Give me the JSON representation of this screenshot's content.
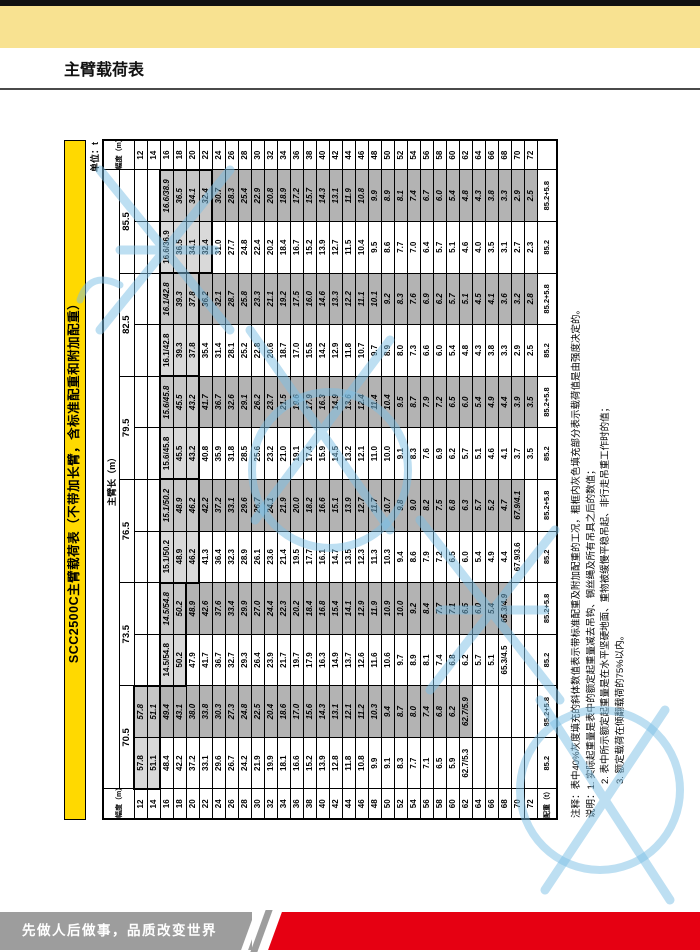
{
  "page": {
    "title": "主臂载荷表",
    "unit_label": "单位：t"
  },
  "table": {
    "title": "SCC2500C主臂载荷表（不带加长臂，含标准配重和附加配重）",
    "radius_header": "幅度（m）",
    "boom_header": "主臂长（m）",
    "counterweight_header": "配重（t）",
    "radii": [
      "12",
      "14",
      "16",
      "18",
      "20",
      "22",
      "24",
      "26",
      "28",
      "30",
      "32",
      "34",
      "36",
      "38",
      "40",
      "42",
      "44",
      "46",
      "48",
      "50",
      "52",
      "54",
      "56",
      "58",
      "60",
      "62",
      "64",
      "66",
      "68",
      "70",
      "72"
    ],
    "booms": [
      {
        "length": "70.5",
        "cw_std": "85.2",
        "cw_add": "85.2+5.8",
        "hl": [
          0,
          1
        ],
        "std": [
          "57.8",
          "51.1",
          "48.4",
          "42.2",
          "37.2",
          "33.1",
          "29.6",
          "26.7",
          "24.2",
          "21.9",
          "19.9",
          "18.1",
          "16.6",
          "15.2",
          "13.9",
          "12.8",
          "11.8",
          "10.8",
          "9.9",
          "9.1",
          "8.3",
          "7.7",
          "7.1",
          "6.5",
          "5.9",
          "62.7/5.3",
          "",
          "",
          "",
          "",
          ""
        ],
        "add": [
          "57.8",
          "51.1",
          "49.4",
          "43.1",
          "38.0",
          "33.8",
          "30.3",
          "27.3",
          "24.8",
          "22.5",
          "20.4",
          "18.6",
          "17.0",
          "15.6",
          "14.3",
          "13.1",
          "12.1",
          "11.2",
          "10.3",
          "9.4",
          "8.7",
          "8.0",
          "7.4",
          "6.8",
          "6.2",
          "62.7/5.9",
          "",
          "",
          "",
          "",
          ""
        ]
      },
      {
        "length": "73.5",
        "cw_std": "85.2",
        "cw_add": "85.2+5.8",
        "hl": [
          2,
          3
        ],
        "std": [
          "",
          "",
          "14.5/54.8",
          "50.2",
          "47.9",
          "41.7",
          "36.7",
          "32.7",
          "29.3",
          "26.4",
          "23.9",
          "21.7",
          "19.7",
          "17.9",
          "16.3",
          "14.9",
          "13.7",
          "12.6",
          "11.6",
          "10.6",
          "9.7",
          "8.9",
          "8.1",
          "7.4",
          "6.8",
          "6.2",
          "5.7",
          "5.1",
          "65.3/4.5",
          "",
          ""
        ],
        "add": [
          "",
          "",
          "14.5/54.8",
          "50.2",
          "48.9",
          "42.6",
          "37.6",
          "33.4",
          "29.9",
          "27.0",
          "24.4",
          "22.3",
          "20.2",
          "18.4",
          "16.8",
          "15.4",
          "14.1",
          "12.9",
          "11.9",
          "10.9",
          "10.0",
          "9.2",
          "8.4",
          "7.7",
          "7.1",
          "6.5",
          "6.0",
          "5.4",
          "65.3/4.9",
          "",
          ""
        ]
      },
      {
        "length": "76.5",
        "cw_std": "85.2",
        "cw_add": "85.2+5.8",
        "hl": [
          2,
          4
        ],
        "std": [
          "",
          "",
          "15.1/50.2",
          "48.9",
          "46.2",
          "41.3",
          "36.4",
          "32.3",
          "28.9",
          "26.1",
          "23.6",
          "21.4",
          "19.5",
          "17.7",
          "16.1",
          "14.7",
          "13.5",
          "12.3",
          "11.3",
          "10.3",
          "9.4",
          "8.6",
          "7.9",
          "7.2",
          "6.5",
          "6.0",
          "5.4",
          "4.9",
          "4.4",
          "67.9/3.6",
          ""
        ],
        "add": [
          "",
          "",
          "15.1/50.2",
          "48.9",
          "46.2",
          "42.2",
          "37.2",
          "33.1",
          "29.6",
          "26.7",
          "24.1",
          "21.9",
          "20.0",
          "18.2",
          "16.6",
          "15.1",
          "13.9",
          "12.7",
          "11.7",
          "10.7",
          "9.8",
          "9.0",
          "8.2",
          "7.5",
          "6.8",
          "6.3",
          "5.7",
          "5.2",
          "4.7",
          "67.9/4.1",
          ""
        ]
      },
      {
        "length": "79.5",
        "cw_std": "85.2",
        "cw_add": "85.2+5.8",
        "hl": [
          2,
          4
        ],
        "std": [
          "",
          "",
          "15.6/45.8",
          "45.5",
          "43.2",
          "40.8",
          "35.9",
          "31.8",
          "28.5",
          "25.6",
          "23.2",
          "21.0",
          "19.1",
          "17.4",
          "15.9",
          "14.5",
          "13.2",
          "12.1",
          "11.0",
          "10.0",
          "9.1",
          "8.3",
          "7.6",
          "6.9",
          "6.2",
          "5.7",
          "5.1",
          "4.6",
          "4.1",
          "3.7",
          "3.5"
        ],
        "add": [
          "",
          "",
          "15.6/45.8",
          "45.5",
          "43.2",
          "41.7",
          "36.7",
          "32.6",
          "29.1",
          "26.2",
          "23.7",
          "21.5",
          "19.6",
          "17.9",
          "16.3",
          "14.9",
          "13.6",
          "12.4",
          "11.4",
          "10.4",
          "9.5",
          "8.7",
          "7.9",
          "7.2",
          "6.5",
          "6.0",
          "5.4",
          "4.9",
          "4.4",
          "3.9",
          "3.5"
        ]
      },
      {
        "length": "82.5",
        "cw_std": "85.2",
        "cw_add": "85.2+5.8",
        "hl": [
          2,
          4
        ],
        "std": [
          "",
          "",
          "16.1/42.8",
          "39.3",
          "37.8",
          "35.4",
          "31.4",
          "28.1",
          "25.2",
          "22.8",
          "20.6",
          "18.7",
          "17.0",
          "15.5",
          "14.2",
          "12.9",
          "11.8",
          "10.7",
          "9.7",
          "8.9",
          "8.0",
          "7.3",
          "6.6",
          "6.0",
          "5.4",
          "4.8",
          "4.3",
          "3.8",
          "3.3",
          "2.9",
          "2.5"
        ],
        "add": [
          "",
          "",
          "16.1/42.8",
          "39.3",
          "37.8",
          "36.2",
          "32.1",
          "28.7",
          "25.8",
          "23.3",
          "21.1",
          "19.2",
          "17.5",
          "16.0",
          "14.6",
          "13.3",
          "12.2",
          "11.1",
          "10.1",
          "9.2",
          "8.3",
          "7.6",
          "6.9",
          "6.2",
          "5.7",
          "5.1",
          "4.5",
          "4.1",
          "3.6",
          "3.2",
          "2.8"
        ]
      },
      {
        "length": "85.5",
        "cw_std": "85.2",
        "cw_add": "85.2+5.8",
        "hl": [
          2,
          5
        ],
        "std": [
          "",
          "",
          "16.6/36.9",
          "36.5",
          "34.1",
          "32.4",
          "31.0",
          "27.7",
          "24.8",
          "22.4",
          "20.2",
          "18.4",
          "16.7",
          "15.2",
          "13.9",
          "12.7",
          "11.5",
          "10.4",
          "9.5",
          "8.6",
          "7.7",
          "7.0",
          "6.4",
          "5.7",
          "5.1",
          "4.6",
          "4.0",
          "3.5",
          "3.1",
          "2.7",
          "2.3"
        ],
        "add": [
          "",
          "",
          "16.6/38.9",
          "36.5",
          "34.1",
          "32.4",
          "30.7",
          "28.3",
          "25.4",
          "22.9",
          "20.8",
          "18.9",
          "17.2",
          "15.7",
          "14.3",
          "13.1",
          "11.9",
          "10.8",
          "9.9",
          "8.9",
          "8.1",
          "7.4",
          "6.7",
          "6.0",
          "5.4",
          "4.8",
          "4.3",
          "3.8",
          "3.3",
          "2.9",
          "2.5"
        ]
      }
    ]
  },
  "notes": [
    "注释：表中40%灰度填充的斜体数值表示带标准配重及附加配重的工况，粗框内灰色填充部分表示载荷值是由强度决定的。",
    "说明：1. 实际起重量是表中的额定起重量减去吊钩、钢丝绳及所有吊具之后的数值；",
    "2. 表中所示额定起重量是在水平坚硬地面、重物被缓慢平稳吊起、非行走吊重工作时的值；",
    "3. 额定载荷在倾翻载荷的75%以内。"
  ],
  "footer": {
    "slogan": "先做人后做事，品质改变世界"
  },
  "colors": {
    "accent_yellow": "#ffd900",
    "band_yellow": "#f8e291",
    "gray_fill": "#b3b3b3",
    "light_fill": "#d9d9d9",
    "footer_red": "#e60012",
    "footer_gray": "#9d9d9d",
    "watermark_blue": "#7cc0e6"
  }
}
